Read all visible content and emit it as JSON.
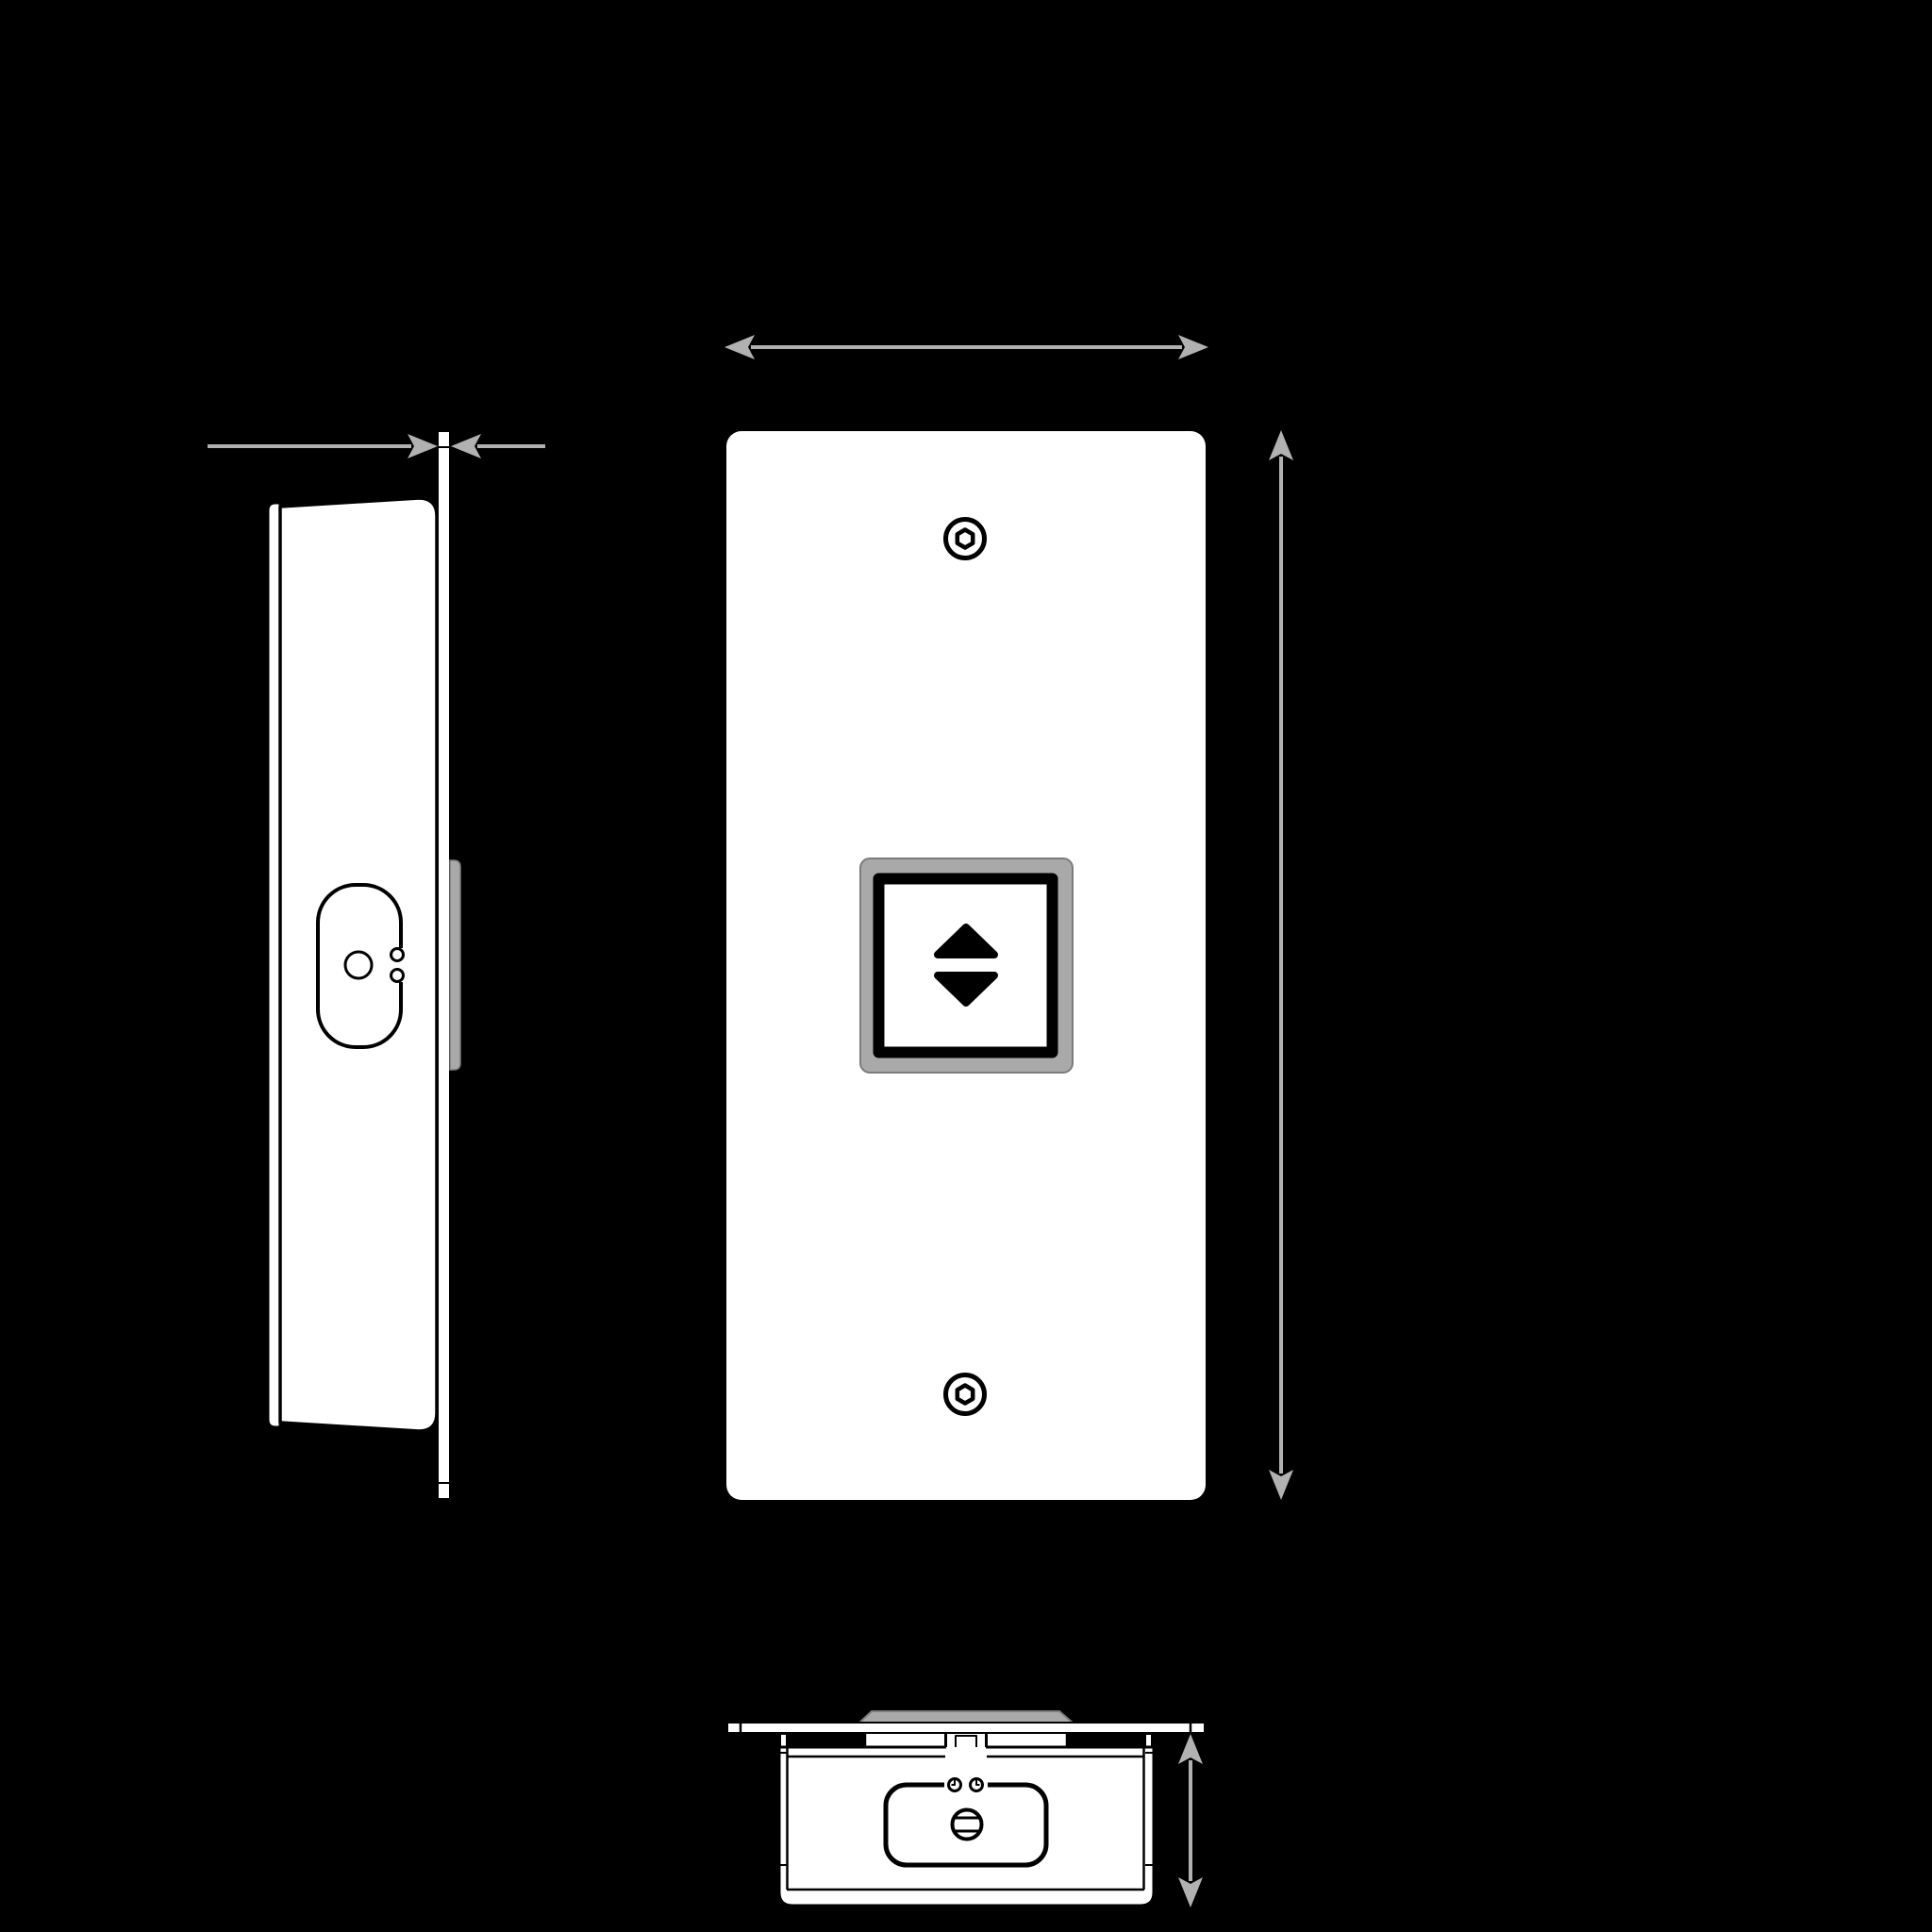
{
  "document": {
    "type": "technical-drawing",
    "views": [
      {
        "id": "side",
        "label": "side-view"
      },
      {
        "id": "front",
        "label": "front-view"
      },
      {
        "id": "bottom",
        "label": "bottom-view"
      }
    ],
    "dimension_arrows": [
      {
        "id": "plate-thickness",
        "view": "side",
        "orientation": "horizontal",
        "style": "double-ended-outside"
      },
      {
        "id": "plate-width",
        "view": "front",
        "orientation": "horizontal",
        "style": "double-ended"
      },
      {
        "id": "plate-height",
        "view": "front",
        "orientation": "vertical",
        "style": "double-ended"
      },
      {
        "id": "housing-depth",
        "view": "bottom",
        "orientation": "vertical",
        "style": "double-ended"
      }
    ],
    "icons": [
      {
        "name": "up-arrow-icon",
        "glyph": "▲"
      },
      {
        "name": "down-arrow-icon",
        "glyph": "▼"
      },
      {
        "name": "hex-socket-screw-icon",
        "glyph": "⬡"
      },
      {
        "name": "slotted-screw-icon",
        "glyph": "⊖"
      }
    ]
  },
  "colors": {
    "background": "#000000",
    "line": "#000000",
    "surface": "#ffffff",
    "dimension": "#b1b1b1",
    "bezel_fill": "#a9a9a9",
    "bezel_stroke": "#7c7c7c"
  }
}
